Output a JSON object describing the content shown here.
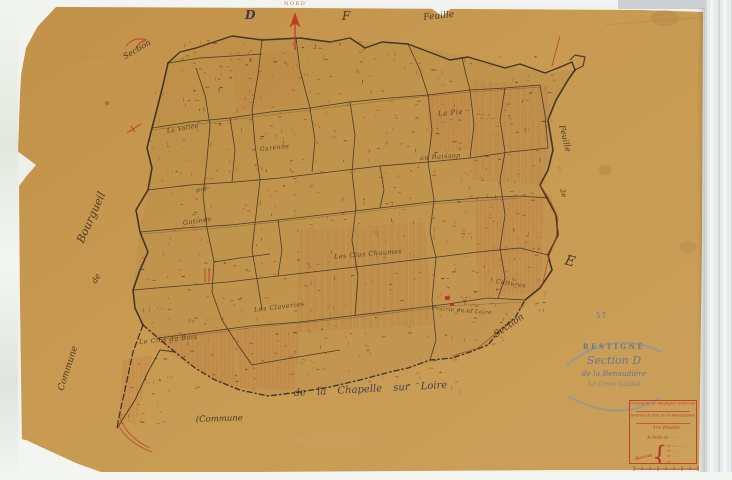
{
  "document_type": "cadastral map scan",
  "colors": {
    "paper": "#c6984f",
    "ink_black": "#2e251c",
    "ink_red": "#b5392b",
    "ink_blue": "#5d74a0",
    "stamp_blue": "#7b91b6",
    "scan_background": "#f1f4f0"
  },
  "compass": {
    "north_label": "NORD"
  },
  "neighbor_sheets": {
    "letter_left": "D",
    "letter_right": "F",
    "feuille_top": "Feuille",
    "section_topleft": "Section",
    "feuille_right": "Feuille",
    "feuille_right_number": "2e",
    "letter_east": "E",
    "section_bottomright": "Section"
  },
  "margins": {
    "left_commune": "Commune",
    "left_de": "de",
    "left_name": "Bourgueil",
    "bottom_commune": "(Commune",
    "bottom_name": "de la Chapelle sur Loire"
  },
  "lieux_dits": [
    {
      "label": "La Vallée",
      "x": 167,
      "y": 128,
      "rot": -10,
      "size": 6
    },
    {
      "label": "Garenne",
      "x": 260,
      "y": 146,
      "rot": -6,
      "size": 6
    },
    {
      "label": "pré",
      "x": 196,
      "y": 187,
      "rot": -8,
      "size": 6
    },
    {
      "label": "Gatines",
      "x": 183,
      "y": 219,
      "rot": -8,
      "size": 6.5
    },
    {
      "label": "La Pie",
      "x": 438,
      "y": 110,
      "rot": -5,
      "size": 7
    },
    {
      "label": "au Buisson",
      "x": 420,
      "y": 154,
      "rot": -4,
      "size": 6.5
    },
    {
      "label": "Les Clos Chaumes",
      "x": 334,
      "y": 253,
      "rot": -5,
      "size": 6.5
    },
    {
      "label": "Les Claveries",
      "x": 254,
      "y": 306,
      "rot": -7,
      "size": 6.5
    },
    {
      "label": "Le Clos du Bois",
      "x": 139,
      "y": 338,
      "rot": -5,
      "size": 6.5
    },
    {
      "label": "Cultures",
      "x": 496,
      "y": 278,
      "rot": 9,
      "size": 6
    },
    {
      "label": "Prairie de la Loire",
      "x": 432,
      "y": 306,
      "rot": 4,
      "size": 5.5
    }
  ],
  "stamp": {
    "number": "57",
    "line1": "RESTIGNÉ",
    "line2": "Section D",
    "line3": "de la Benaudière",
    "line4": "La Croix Guillot",
    "line5": "· · · · · · ·"
  },
  "cartouche": {
    "line1": "Commune de Restigné (Indre-et-Loire)",
    "line2": "Section D dite de la Benaudière",
    "feuille": "1re Feuille",
    "echelle": "Échelle de · · · ·",
    "renvois_label": "Renvois",
    "renvois": [
      "N° 1 ·········",
      "N° ··· ·····",
      "N° ·· ····",
      "N° ····· ··",
      "· ·····"
    ]
  }
}
